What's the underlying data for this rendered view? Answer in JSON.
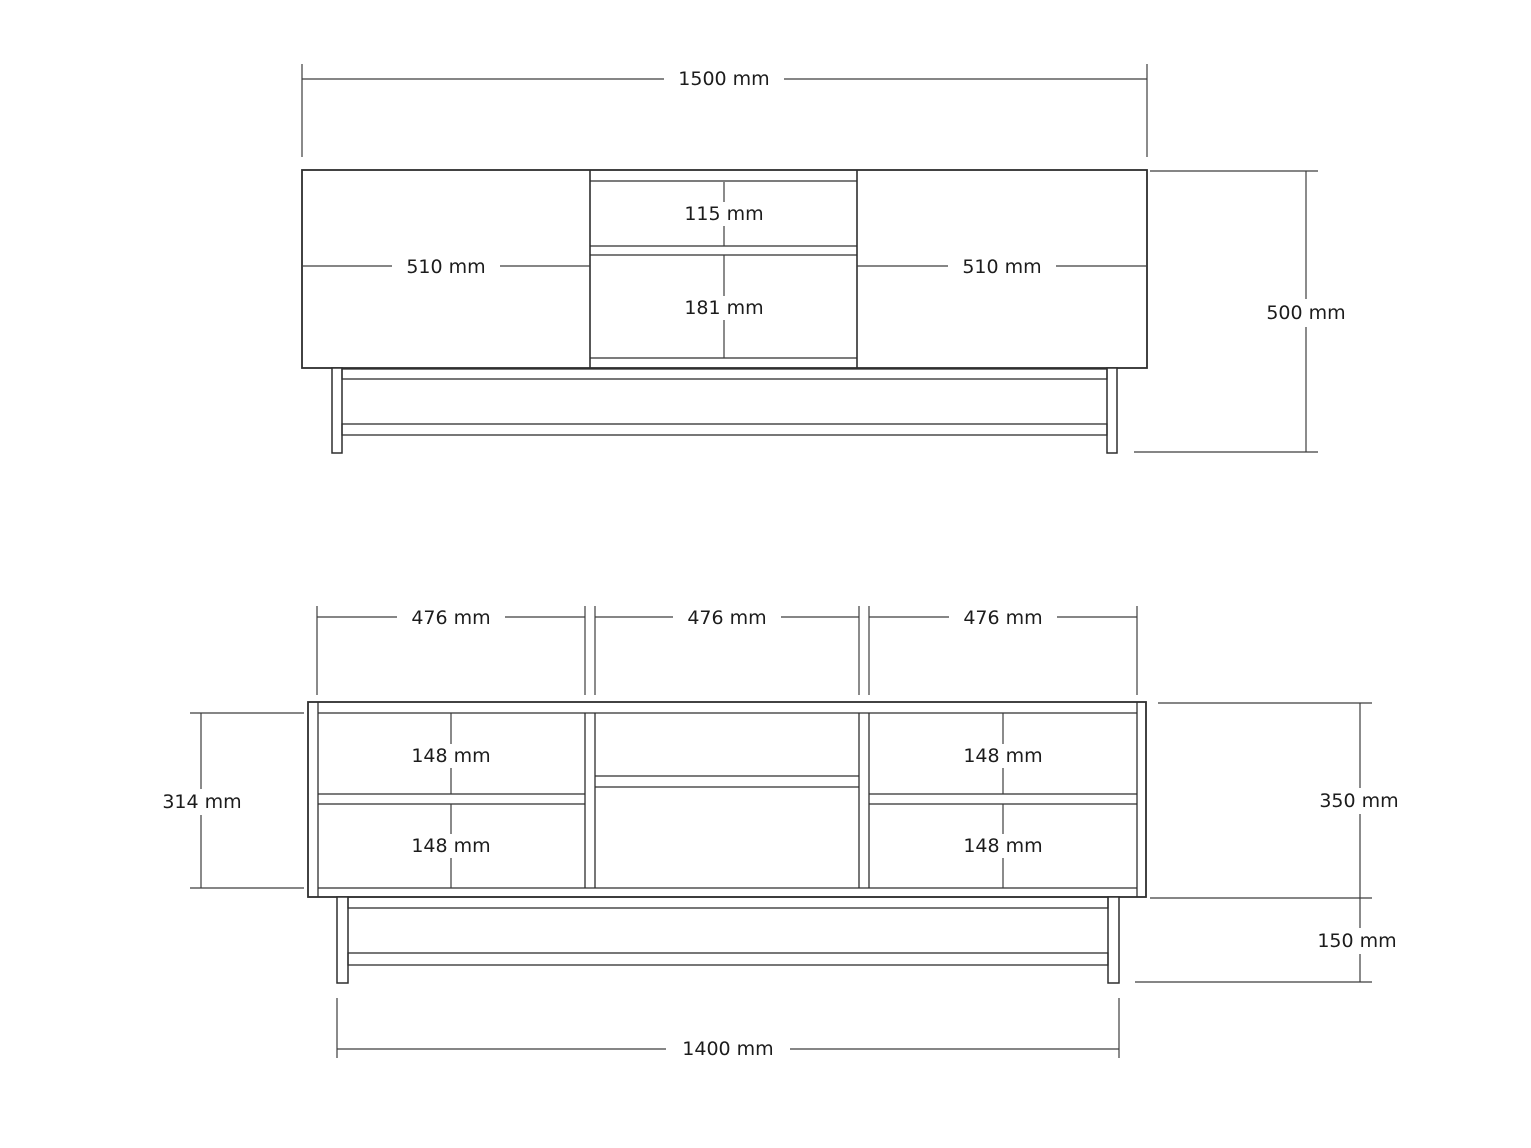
{
  "front_view": {
    "width": "1500 mm",
    "height": "500 mm",
    "left_door": "510 mm",
    "right_door": "510 mm",
    "drawer_upper": "115 mm",
    "drawer_lower": "181 mm"
  },
  "base_view": {
    "section_left": "476 mm",
    "section_middle": "476 mm",
    "section_right": "476 mm",
    "interior_height": "314 mm",
    "carcass_height": "350 mm",
    "leg_height": "150 mm",
    "base_width": "1400 mm",
    "drawer_left_upper": "148 mm",
    "drawer_left_lower": "148 mm",
    "drawer_right_upper": "148 mm",
    "drawer_right_lower": "148 mm"
  },
  "colors": {
    "line": "#2e2e2e",
    "dimension_line": "#3d3d3d",
    "text": "#1c1c1c",
    "background": "#ffffff"
  }
}
